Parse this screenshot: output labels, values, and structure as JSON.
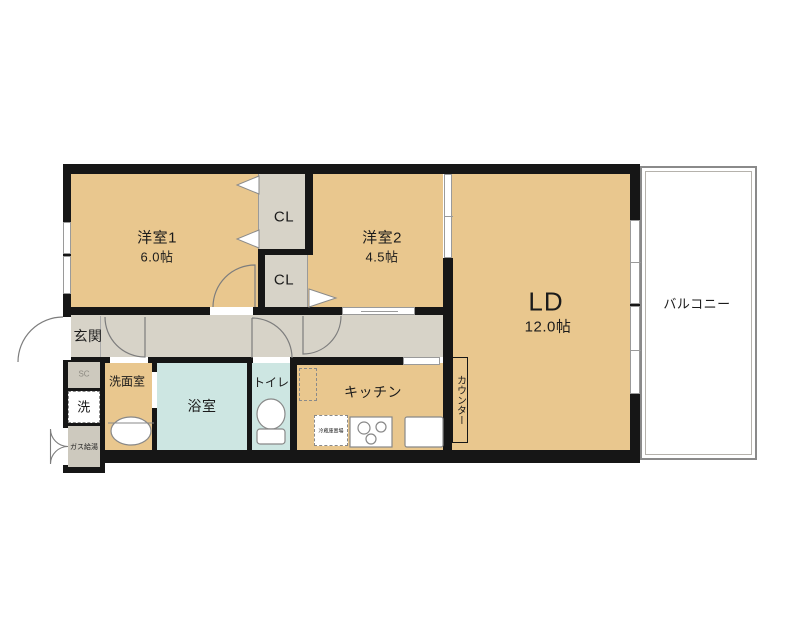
{
  "floorplan": {
    "rooms": {
      "bedroom1": {
        "name": "洋室1",
        "size": "6.0帖"
      },
      "bedroom2": {
        "name": "洋室2",
        "size": "4.5帖"
      },
      "living_dining": {
        "name": "LD",
        "size": "12.0帖"
      },
      "closet_upper": {
        "name": "CL"
      },
      "closet_lower": {
        "name": "CL"
      },
      "entrance": {
        "name": "玄関"
      },
      "washroom": {
        "name": "洗面室"
      },
      "bathroom": {
        "name": "浴室"
      },
      "toilet": {
        "name": "トイレ"
      },
      "kitchen": {
        "name": "キッチン"
      },
      "counter": {
        "name": "カウンター"
      },
      "balcony": {
        "name": "バルコニー"
      },
      "shoe_closet": {
        "name": "SC"
      },
      "washer_space": {
        "name": "洗"
      },
      "gas_heater": {
        "name": "ガス給湯"
      },
      "fridge_space": {
        "name": "冷蔵庫置場"
      }
    },
    "colors": {
      "wall": "#161616",
      "room_tan": "#e9c78e",
      "hall_gray": "#d7d3c8",
      "bath_blue": "#cde6e2",
      "line_gray": "#9a9a9a"
    }
  }
}
